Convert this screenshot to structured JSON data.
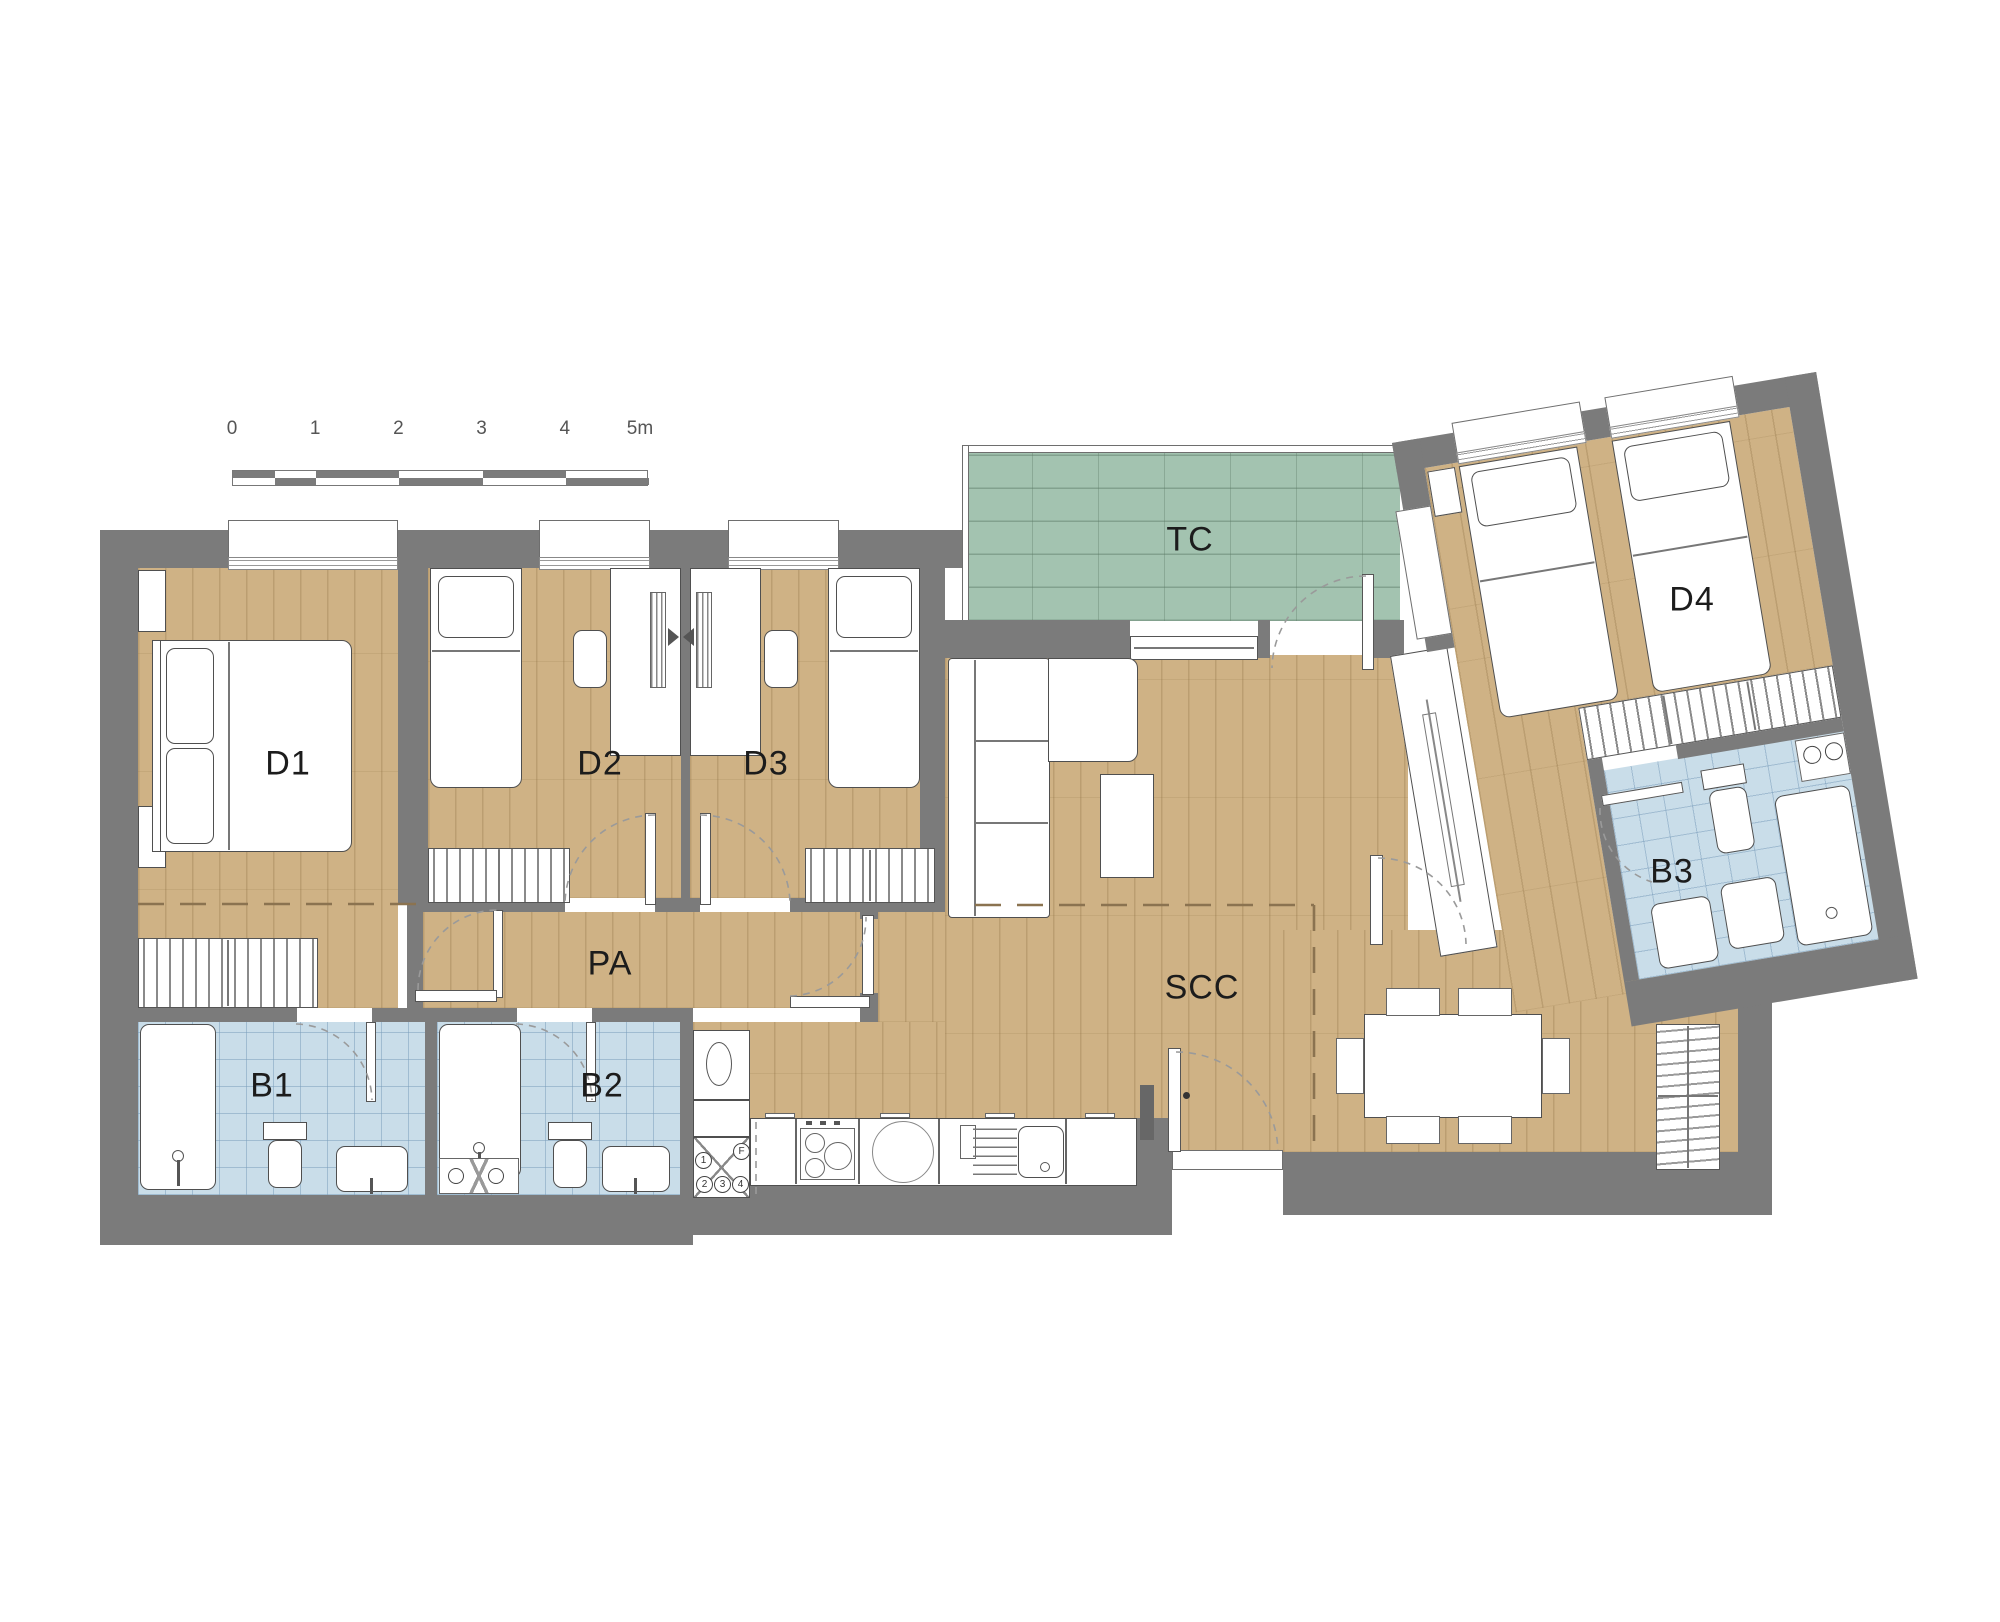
{
  "plan_title": "apartment-floor-plan",
  "scalebar": {
    "ticks": [
      "0",
      "1",
      "2",
      "3",
      "4",
      "5m"
    ]
  },
  "rooms": {
    "d1": {
      "label": "D1"
    },
    "d2": {
      "label": "D2"
    },
    "d3": {
      "label": "D3"
    },
    "d4": {
      "label": "D4"
    },
    "b1": {
      "label": "B1"
    },
    "b2": {
      "label": "B2"
    },
    "b3": {
      "label": "B3"
    },
    "pa": {
      "label": "PA"
    },
    "scc": {
      "label": "SCC"
    },
    "tc": {
      "label": "TC"
    }
  },
  "kitchen": {
    "unit_symbols": [
      "1",
      "2",
      "3",
      "4",
      "F"
    ]
  },
  "colors": {
    "wall": "#7b7b7b",
    "wood": "#cfb285",
    "bath": "#c9dde9",
    "terrace": "#a3c3b0",
    "dash": "#8b7350"
  }
}
